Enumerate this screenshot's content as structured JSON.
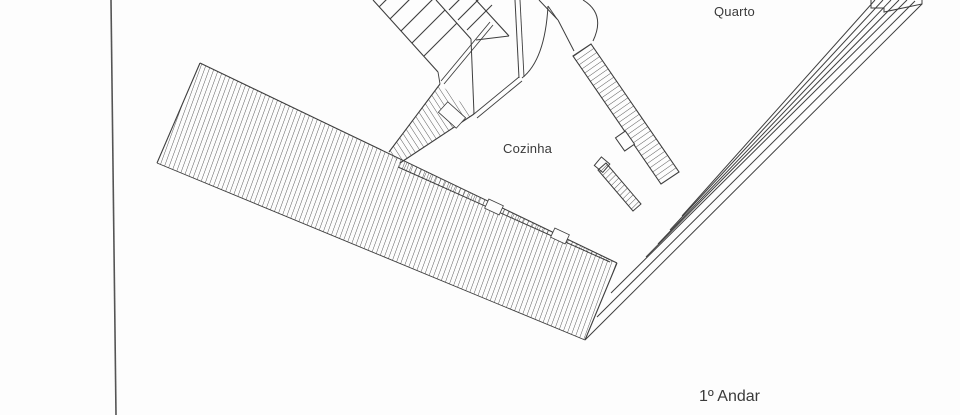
{
  "page": {
    "background": "#fdfdfd",
    "line_color": "#3e3e3e",
    "hatch_color": "#4a4a4a",
    "text_color": "#3a3a3a"
  },
  "plan": {
    "floor_label": "1º Andar",
    "rooms": [
      {
        "name": "Cozinha"
      },
      {
        "name": "Quarto"
      }
    ],
    "features": [
      "staircase",
      "door-swing-arcs",
      "hatched-terrace-band",
      "hatched-wall-sections",
      "page-border-line"
    ]
  }
}
